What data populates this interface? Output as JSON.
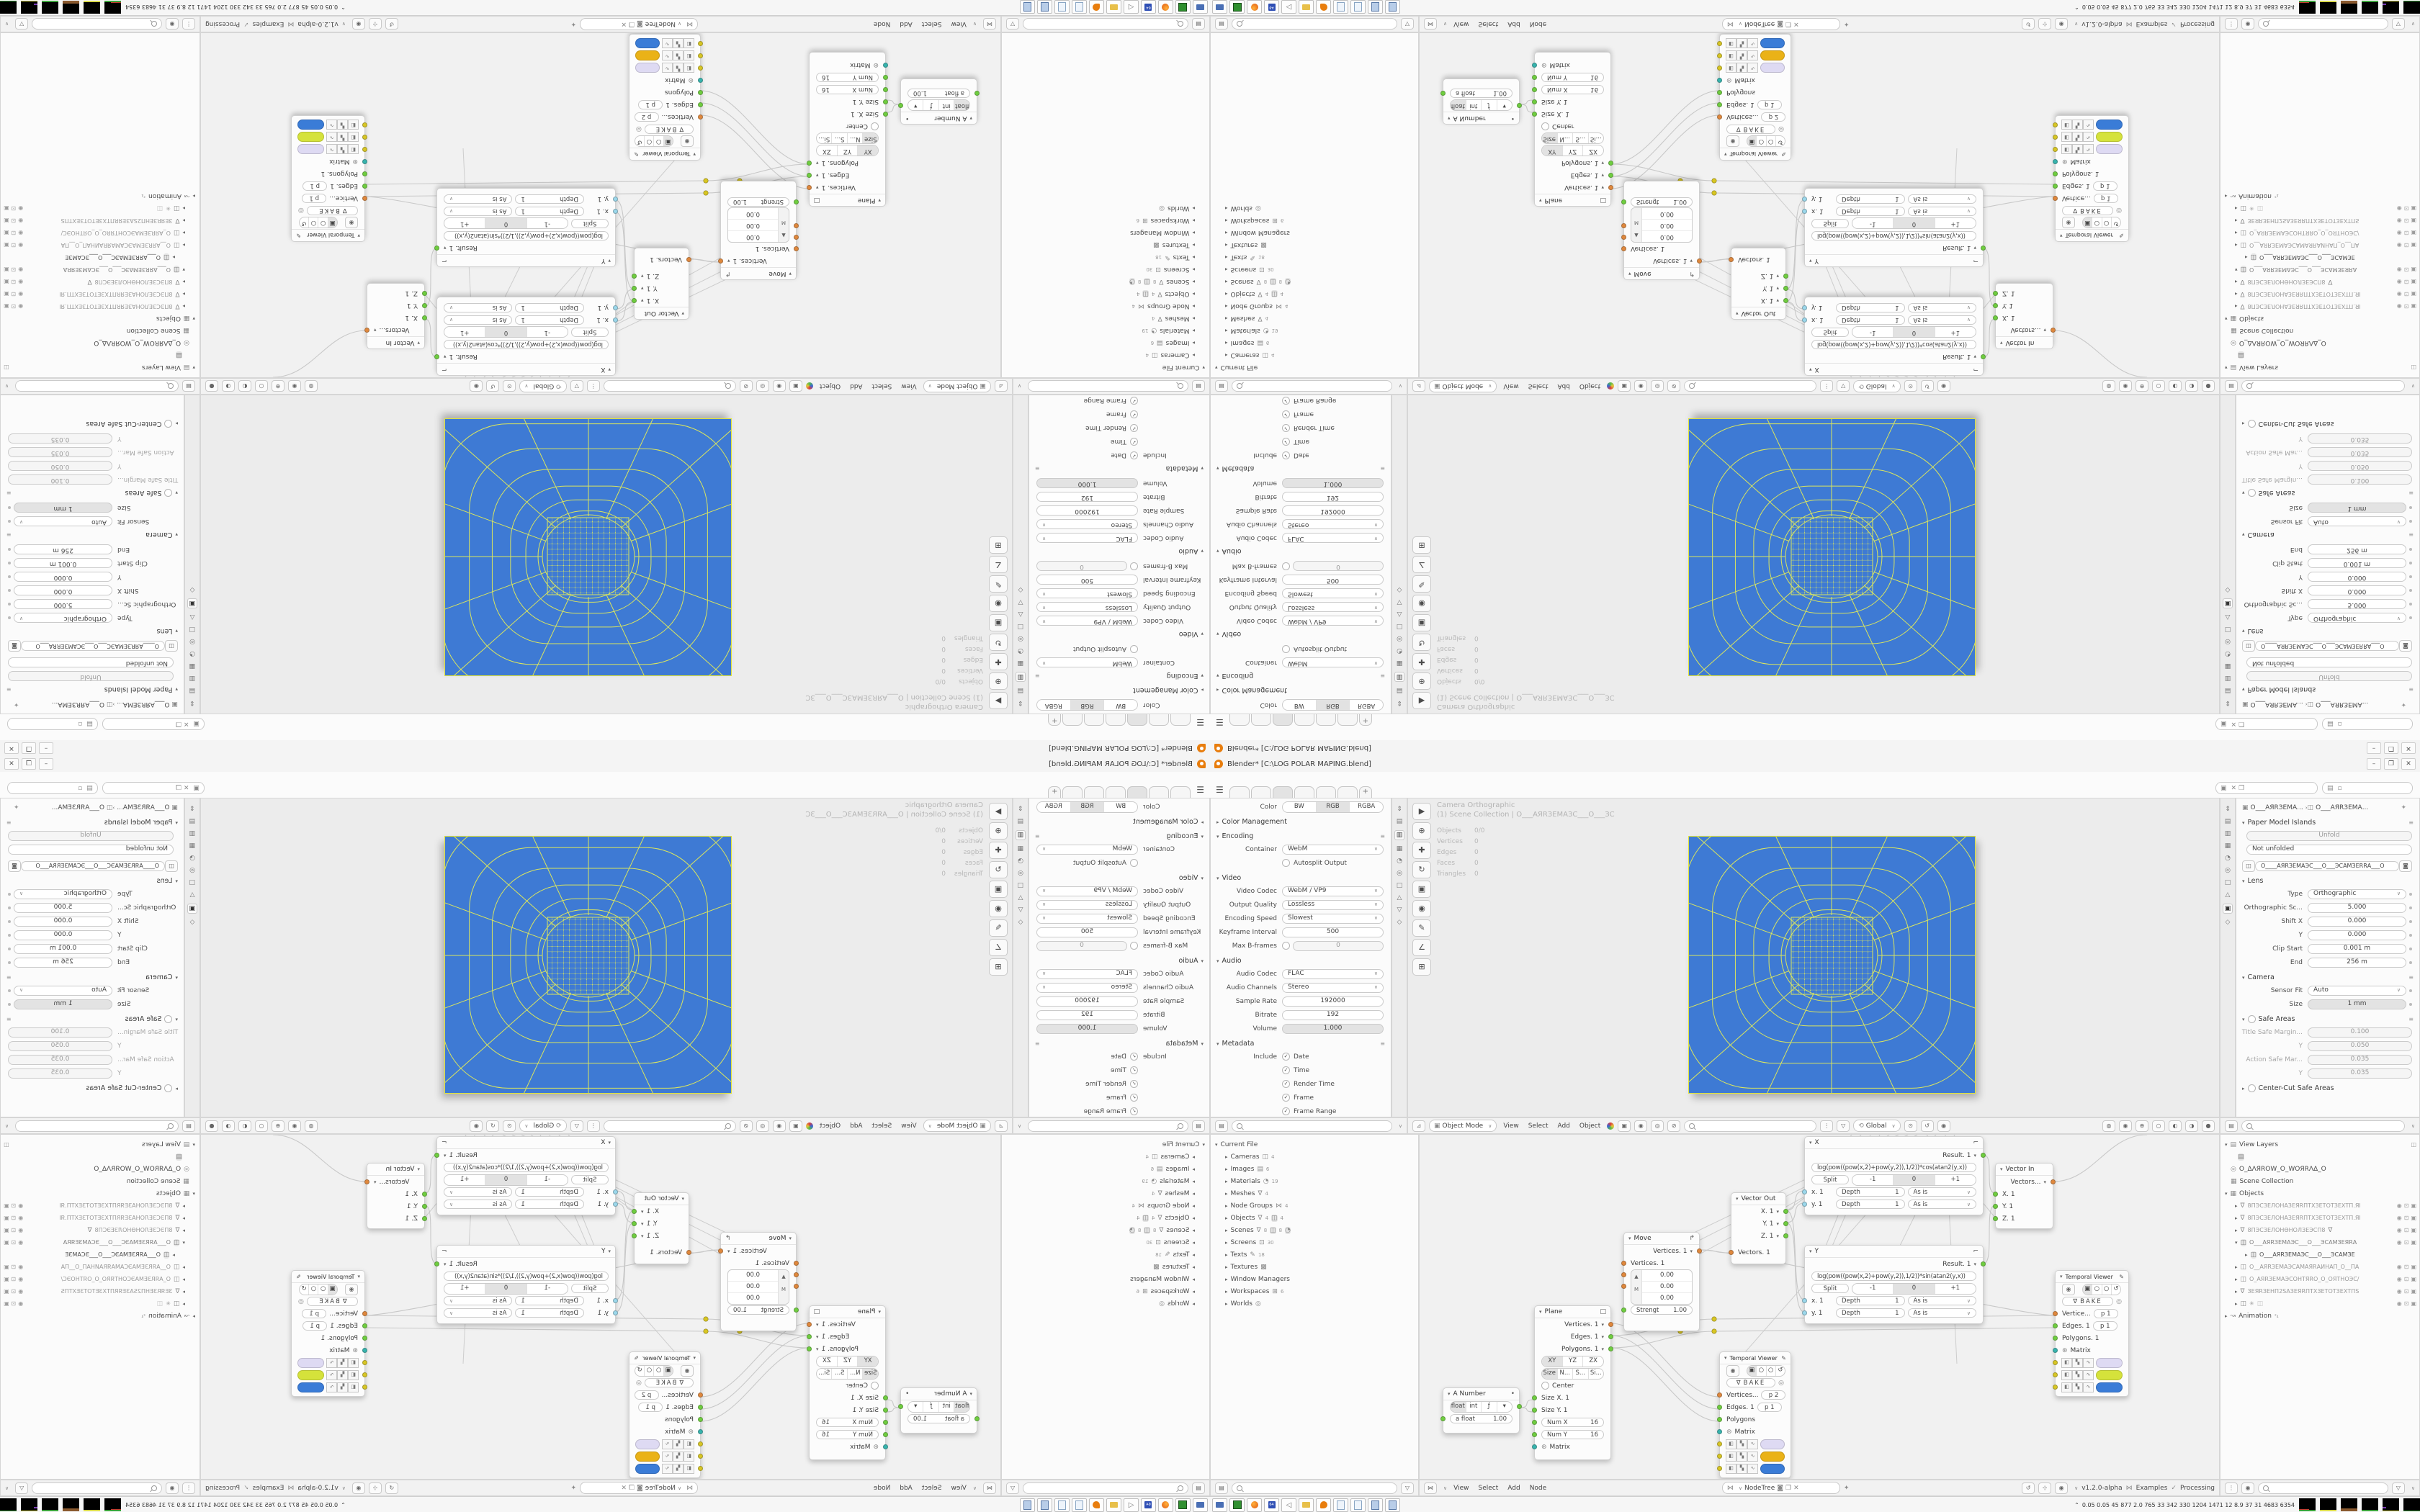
{
  "window": {
    "title": "Blender* [C:\\LOG POLAR MAPING.blend]",
    "minimize": "–",
    "maximize": "❐",
    "close": "✕"
  },
  "icons": {
    "hamburger": "☰",
    "caret": "∨",
    "tri_open": "▾",
    "tri_closed": "▸",
    "plus": "+",
    "check": "✓",
    "pin": "✦",
    "eye": "◉",
    "screen": "⊡",
    "cam_restrict": "▣",
    "preset": "≡",
    "funnel": "▽",
    "filter": "⇕"
  },
  "colors": {
    "blue": "#3e7ad4",
    "wire_yellow": "#dae55e",
    "outline_yellow": "#dde23c",
    "accent_orange": "#e87d0d",
    "swatch_lavender": "#dedaf3",
    "swatch_gold": "#eab217",
    "swatch_yellowgreen": "#d5e23b",
    "swatch_blue": "#3a7cd7"
  },
  "props_out": {
    "color_label": "Color",
    "bw": "BW",
    "rgb": "RGB",
    "rgba": "RGBA",
    "color_mgmt": "Color Management",
    "encoding": "Encoding",
    "container_label": "Container",
    "container": "WebM",
    "autosplit": "Autosplit Output",
    "video": "Video",
    "video_codec_label": "Video Codec",
    "video_codec": "WebM / VP9",
    "quality_label": "Output Quality",
    "quality": "Lossless",
    "speed_label": "Encoding Speed",
    "speed": "Slowest",
    "keyframe_label": "Keyframe Interval",
    "keyframe": "500",
    "bframes_label": "Max B-frames",
    "bframes": "0",
    "audio": "Audio",
    "audio_codec_label": "Audio Codec",
    "audio_codec": "FLAC",
    "channels_label": "Audio Channels",
    "channels": "Stereo",
    "sample_label": "Sample Rate",
    "sample": "192000",
    "bitrate_label": "Bitrate",
    "bitrate": "192",
    "volume_label": "Volume",
    "volume": "1.000",
    "metadata": "Metadata",
    "include_label": "Include",
    "meta_items": [
      "Date",
      "Time",
      "Render Time",
      "Frame",
      "Frame Range"
    ]
  },
  "viewport": {
    "overlay_title": "Camera Orthographic",
    "overlay_scene": "(1) Scene Collection | O___AЯRЗЕМАЗС___O___ЗС",
    "stats": [
      {
        "label": "Objects",
        "value": "0/0"
      },
      {
        "label": "Vertices",
        "value": "0"
      },
      {
        "label": "Edges",
        "value": "0"
      },
      {
        "label": "Faces",
        "value": "0"
      },
      {
        "label": "Triangles",
        "value": "0"
      }
    ]
  },
  "vp_header": {
    "mode": "Object Mode",
    "menus": [
      "View",
      "Select",
      "Add",
      "Object"
    ],
    "orientation": "Global"
  },
  "camera_props": {
    "breadcrumb_obj": "O___AЯRЗЕМА...",
    "breadcrumb_data": "O___AЯRЗЕМА...",
    "paper_model": "Paper Model Islands",
    "unfold": "Unfold",
    "not_unfolded": "Not unfolded",
    "datablock": "O____AЯRЗЕМАЭС___O___ЭСАМЗЕRRА___O",
    "lens": "Lens",
    "type_label": "Type",
    "type": "Orthographic",
    "ortho_label": "Orthographic Sc...",
    "ortho": "5.000",
    "shiftx_label": "Shift X",
    "shiftx": "0.000",
    "shifty_label": "Y",
    "shifty": "0.000",
    "clip_label": "Clip Start",
    "clip": "0.001 m",
    "end_label": "End",
    "end": "256 m",
    "camera": "Camera",
    "sensor_label": "Sensor Fit",
    "sensor": "Auto",
    "size_label": "Size",
    "size": "1 mm",
    "safe": "Safe Areas",
    "title_safe_label": "Title Safe Margin...",
    "title_safe": "0.100",
    "ty_label": "Y",
    "ty": "0.050",
    "action_label": "Action Safe Mar...",
    "action": "0.035",
    "ay_label": "Y",
    "ay": "0.035",
    "center_cut": "Center-Cut Safe Areas"
  },
  "outliner_file": {
    "root": "Current File",
    "items": [
      {
        "label": "Cameras",
        "count": "4"
      },
      {
        "label": "Images",
        "count": "6"
      },
      {
        "label": "Materials",
        "count": "19"
      },
      {
        "label": "Meshes",
        "count": "4"
      },
      {
        "label": "Node Groups",
        "count": "4"
      },
      {
        "label": "Objects",
        "count": "4"
      },
      {
        "label": "Scenes",
        "count": "8"
      },
      {
        "label": "Screens",
        "count": "30"
      },
      {
        "label": "Texts",
        "count": "18"
      },
      {
        "label": "Textures",
        "count": ""
      },
      {
        "label": "Window Managers",
        "count": ""
      },
      {
        "label": "Workspaces",
        "count": "6"
      },
      {
        "label": "Worlds",
        "count": ""
      }
    ]
  },
  "outliner_layers": {
    "root": "View Layers",
    "world": "O_ΔΛЯROW_O_WOЯRΛΔ_O",
    "scene_collection": "Scene Collection",
    "objects": "Objects",
    "items": [
      "8ПЭСЗЕЛОНАЗЕЯRПТХЗЕТОТЗЕХТП.ЯI",
      "8ПЭСЗЕЛОНАЗЕЯRПТХЗЕТОТЗЕХТП.ЯI",
      "8ПЭСЗЕЛОНѲНОЛЗЕЭСП8",
      "O___AЯRЗЕМАЭС___O___ЭСАМЗЕЯRА",
      "O___AЯRЗЕМАЭС___O___ЭСАМЗЕ",
      "O__AЯRЗЕМАЭСАМАЯRАИНАП_O__ПА",
      "O_AЯRЗЕМАЭСОНТЯRО_O_ОЯТНОЭС/",
      "ЗЕЯRЗЕНП2SАЗЕЯRПТХЗЕТОТЗЕХТПS",
      "✳"
    ],
    "animation": "Animation",
    "anim_badge": "²₄"
  },
  "nodes": {
    "a_number": {
      "title": "A Number",
      "float": "float",
      "int": "int",
      "value_label": "a float",
      "value": "1.00"
    },
    "plane": {
      "title": "Plane",
      "out1": "Vertices. 1",
      "out2": "Edges. 1",
      "out3": "Polygons. 1",
      "xy": "XY",
      "yz": "YZ",
      "zx": "ZX",
      "size": "Size",
      "n": "N...",
      "s": "S...",
      "si": "Si...",
      "center": "Center",
      "sx": "Size X. 1",
      "sy": "Size Y. 1",
      "numx_label": "Num X",
      "numx": "16",
      "numy_label": "Num Y",
      "numy": "16",
      "matrix": "Matrix"
    },
    "move": {
      "title": "Move",
      "out": "Vertices. 1",
      "in": "Vertices. 1",
      "m": "M",
      "v1": "0.00",
      "v2": "0.00",
      "v3": "0.00",
      "strength_label": "Strengt",
      "strength": "1.00"
    },
    "vector_out": {
      "title": "Vector Out",
      "x": "X. 1",
      "y": "Y. 1",
      "z": "Z. 1",
      "in": "Vectors. 1"
    },
    "x_node": {
      "title": "X",
      "result": "Result. 1",
      "formula": "log(pow((pow(x,2)+pow(y,2)),1/2))*cos(atan2(y,x))",
      "split": "Split",
      "m1": "-1",
      "zero": "0",
      "p1": "+1",
      "x_in": "x. 1",
      "y_in": "y. 1",
      "depth": "Depth",
      "one": "1",
      "asis": "As is"
    },
    "y_node": {
      "title": "Y",
      "result": "Result. 1",
      "formula": "log(pow((pow(x,2)+pow(y,2)),1/2))*sin(atan2(y,x))",
      "split": "Split",
      "m1": "-1",
      "zero": "0",
      "p1": "+1",
      "x_in": "x. 1",
      "y_in": "y. 1",
      "depth": "Depth",
      "one": "1",
      "asis": "As is"
    },
    "vector_in": {
      "title": "Vector In",
      "out": "Vectors...",
      "x": "X. 1",
      "y": "Y. 1",
      "z": "Z. 1"
    },
    "tviewer_c": {
      "title": "Temporal Viewer",
      "bake": "BAKE",
      "r1": "Vertices...",
      "r1v": "p  2",
      "r2": "Edges. 1",
      "r2v": "p  1",
      "r3": "Polygons",
      "r4": "Matrix"
    },
    "tviewer_r": {
      "title": "Temporal Viewer",
      "bake": "BAKE",
      "r1": "Vertice...",
      "r1v": "p  1",
      "r2": "Edges. 1",
      "r2v": "p  1",
      "r3": "Polygons. 1",
      "r4": "Matrix"
    }
  },
  "node_header": {
    "menus": [
      "View",
      "Select",
      "Add",
      "Node"
    ],
    "tree": "NodeTree",
    "version": "v1.2.0-alpha",
    "examples": "Examples",
    "processing": "Processing"
  },
  "taskbar": {
    "stats": "0.05 0.05   45    877    2.0   765    33    342   330  1204 1471   12    8.9    37     31   4683 6354"
  }
}
